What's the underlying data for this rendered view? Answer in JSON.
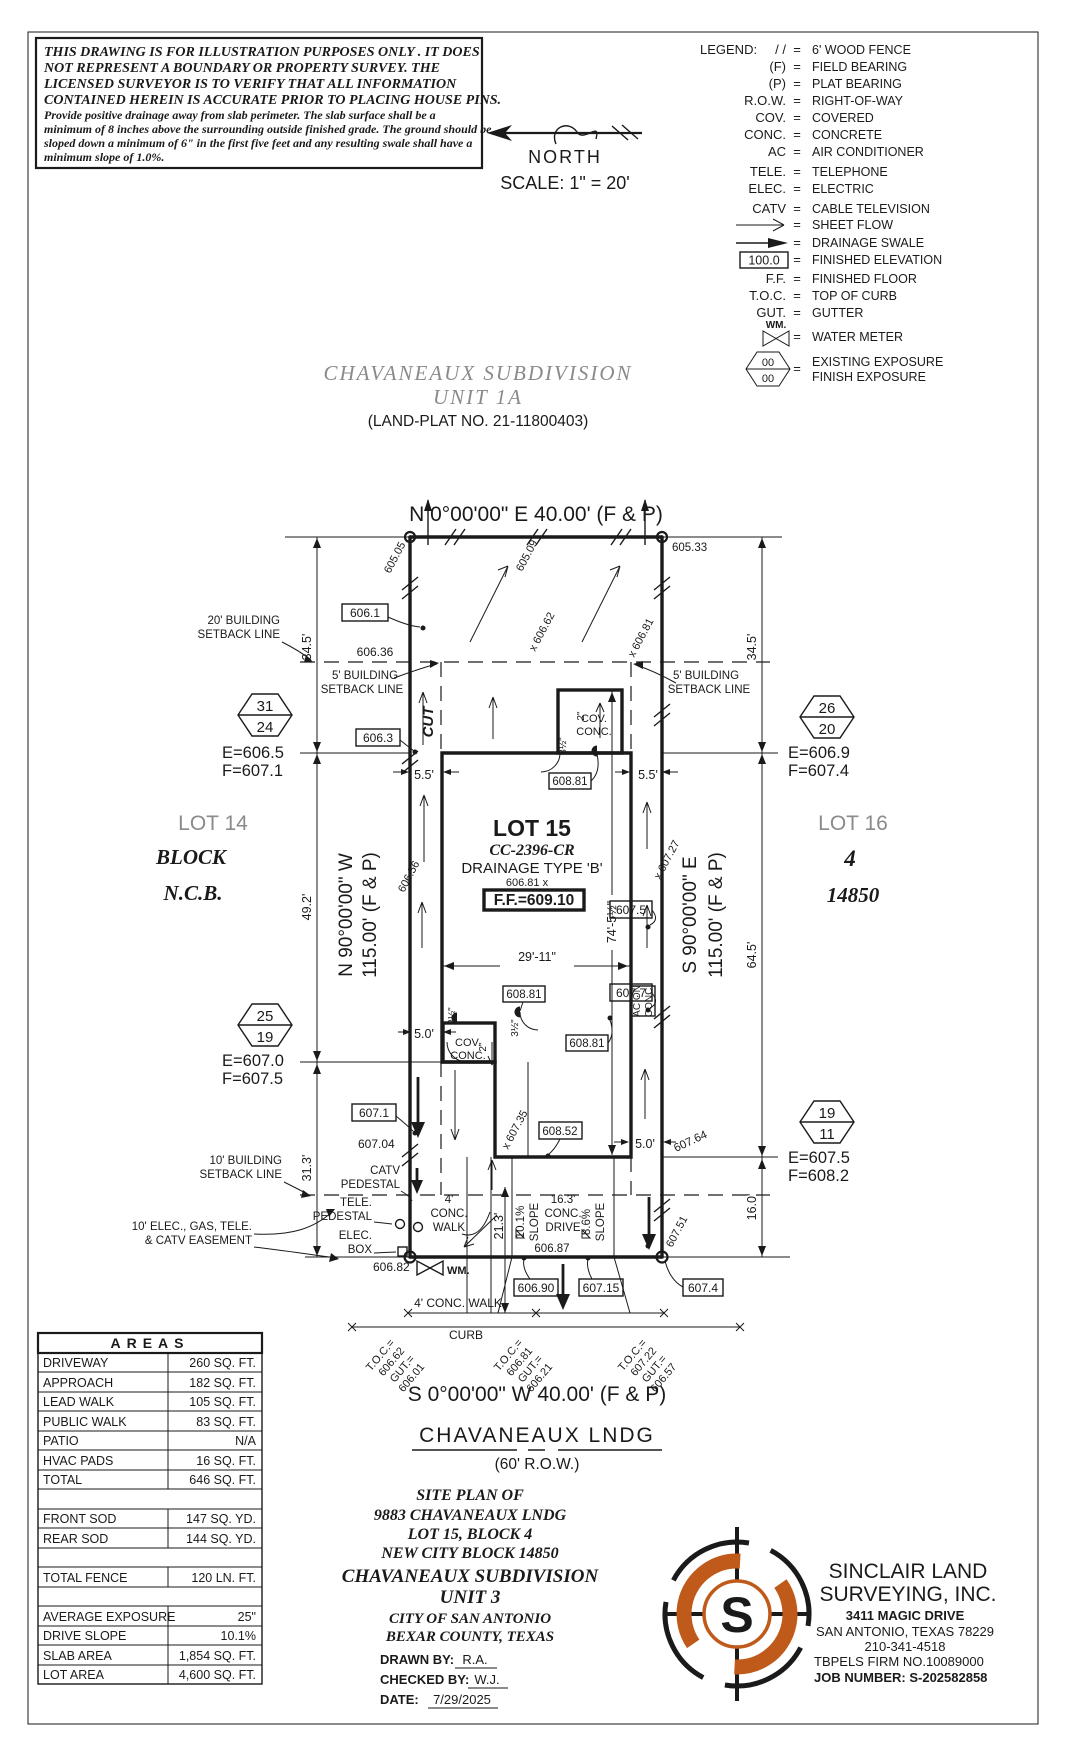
{
  "colors": {
    "ink": "#1a1a1a",
    "gray": "#8a8a8a",
    "orange": "#c05a1a"
  },
  "disclaimer": {
    "b1": "THIS DRAWING IS FOR ILLUSTRATION PURPOSES ONLY . IT DOES",
    "b2": "NOT REPRESENT A BOUNDARY OR PROPERTY SURVEY. THE",
    "b3": "LICENSED SURVEYOR IS TO VERIFY THAT ALL INFORMATION",
    "b4": "CONTAINED HEREIN IS ACCURATE PRIOR TO PLACING HOUSE PINS.",
    "s1": "Provide positive drainage away from slab perimeter. The slab surface shall be a",
    "s2": "minimum of 8 inches above the surrounding outside finished grade. The ground should be",
    "s3": "sloped down a minimum of 6\" in the first five feet and any resulting swale shall have a",
    "s4": "minimum slope of 1.0%."
  },
  "north": {
    "label": "NORTH",
    "scale": "SCALE:  1\" = 20'"
  },
  "legend": {
    "title": "LEGEND:",
    "eq": "=",
    "rows": [
      {
        "sym": "/ /",
        "desc": "6' WOOD FENCE"
      },
      {
        "sym": "(F)",
        "desc": "FIELD BEARING"
      },
      {
        "sym": "(P)",
        "desc": "PLAT BEARING"
      },
      {
        "sym": "R.O.W.",
        "desc": "RIGHT-OF-WAY"
      },
      {
        "sym": "COV.",
        "desc": "COVERED"
      },
      {
        "sym": "CONC.",
        "desc": "CONCRETE"
      },
      {
        "sym": "AC",
        "desc": "AIR CONDITIONER"
      },
      {
        "sym": "TELE.",
        "desc": "TELEPHONE"
      },
      {
        "sym": "ELEC.",
        "desc": "ELECTRIC"
      },
      {
        "sym": "CATV",
        "desc": "CABLE TELEVISION"
      },
      {
        "sym": "",
        "desc": "SHEET FLOW"
      },
      {
        "sym": "",
        "desc": "DRAINAGE SWALE"
      },
      {
        "sym": "100.0",
        "desc": "FINISHED ELEVATION"
      },
      {
        "sym": "F.F.",
        "desc": "FINISHED FLOOR"
      },
      {
        "sym": "T.O.C.",
        "desc": "TOP OF CURB"
      },
      {
        "sym": "GUT.",
        "desc": "GUTTER"
      },
      {
        "sym": "WM.",
        "desc": "WATER METER"
      }
    ],
    "exposure": {
      "top": "00",
      "bottom": "00",
      "desc1": "EXISTING EXPOSURE",
      "desc2": "FINISH EXPOSURE"
    }
  },
  "header": {
    "subdivision": "CHAVANEAUX  SUBDIVISION",
    "unit": "UNIT  1A",
    "plat": "(LAND-PLAT NO. 21-11800403)"
  },
  "bearings": {
    "top": "N  0°00'00\"  E  40.00'  (F & P)",
    "bottom": "S  0°00'00\"  W  40.00'  (F & P)",
    "left1": "N  90°00'00\"  W",
    "left2": "115.00'  (F & P)",
    "right1": "S  90°00'00\"  E",
    "right2": "115.00'  (F & P)"
  },
  "street": {
    "name": "CHAVANEAUX  LNDG",
    "row": "(60'  R.O.W.)"
  },
  "adjacent": {
    "lot14": "LOT 14",
    "block": "BLOCK",
    "ncb": "N.C.B.",
    "lot16": "LOT 16",
    "block_no": "4",
    "ncb_no": "14850"
  },
  "lot": {
    "name": "LOT 15",
    "cc": "CC-2396-CR",
    "drainage": "DRAINAGE TYPE 'B'",
    "spot": "606.81 x",
    "ff": "F.F.=609.10"
  },
  "markers": [
    {
      "top": "31",
      "bottom": "24",
      "e": "E=606.5",
      "f": "F=607.1"
    },
    {
      "top": "25",
      "bottom": "19",
      "e": "E=607.0",
      "f": "F=607.5"
    },
    {
      "top": "26",
      "bottom": "20",
      "e": "E=606.9",
      "f": "F=607.4"
    },
    {
      "top": "19",
      "bottom": "11",
      "e": "E=607.5",
      "f": "F=608.2"
    }
  ],
  "dims": {
    "d345l": "34.5'",
    "d492": "49.2'",
    "d313": "31.3'",
    "d345r": "34.5'",
    "d645": "64.5'",
    "d160": "16.0'",
    "d55l": "5.5'",
    "d55r": "5.5'",
    "d50a": "5.0'",
    "d50b": "5.0'",
    "d2911": "29'-11\"",
    "d745": "74'-5½\"",
    "d213": "21.3'",
    "d2a": "2\"",
    "d2b": "2\"",
    "d35a": "3½\"",
    "d35b": "3½\"",
    "d35c": "3½\""
  },
  "setbacks": {
    "s20a": "20' BUILDING",
    "s20b": "SETBACK LINE",
    "s5la": "5' BUILDING",
    "s5lb": "SETBACK LINE",
    "s5ra": "5' BUILDING",
    "s5rb": "SETBACK LINE",
    "s10a": "10' BUILDING",
    "s10b": "SETBACK LINE",
    "easea": "10' ELEC., GAS, TELE.",
    "easeb": "& CATV EASEMENT"
  },
  "boxes": {
    "b6061": "606.1",
    "b6063": "606.3",
    "b6071": "607.1",
    "b60881a": "608.81",
    "b60881b": "608.81",
    "b60881c": "608.81",
    "b60852": "608.52",
    "b6075": "607.5",
    "b6077": "607.7",
    "b60690": "606.90",
    "b60715": "607.15",
    "b6074": "607.4"
  },
  "spots": {
    "s60505": "605.05",
    "s60509": "605.09",
    "s60533": "605.33",
    "s60636": "606.36",
    "s60662": "x 606.62",
    "s60681": "x 606.81",
    "s60656": "606.56",
    "s60727": "x 607.27",
    "s60704": "607.04",
    "s60735": "x 607.35",
    "s60764": "607.64",
    "s60751": "607.51",
    "s60687": "606.87",
    "s60682": "606.82"
  },
  "toc": [
    {
      "l1": "T.O.C.=",
      "l2": "606.62",
      "l3": "GUT.=",
      "l4": "606.01"
    },
    {
      "l1": "T.O.C.=",
      "l2": "606.81",
      "l3": "GUT.=",
      "l4": "606.21"
    },
    {
      "l1": "T.O.C.=",
      "l2": "607.22",
      "l3": "GUT.=",
      "l4": "606.57"
    }
  ],
  "site": {
    "cut": "CUT",
    "cova": "COV.",
    "covb": "CONC.",
    "cov2a": "COV.",
    "cov2b": "CONC.",
    "ac1": "AC ON",
    "ac2": "CONC.",
    "wm": "WM.",
    "catv1": "CATV",
    "catv2": "PEDESTAL",
    "tele1": "TELE.",
    "tele2": "PEDESTAL",
    "elec1": "ELEC.",
    "elec2": "BOX",
    "walk1": "4'",
    "walk2": "CONC.",
    "walk3": "WALK",
    "slope1a": "10.1%",
    "slope1b": "SLOPE",
    "drive1": "16.3'",
    "drive2": "CONC.",
    "drive3": "DRIVE",
    "slope2a": "8.6%",
    "slope2b": "SLOPE",
    "pubwalk": "4' CONC. WALK",
    "curb": "CURB"
  },
  "table": {
    "title": "AREAS",
    "rows": [
      {
        "label": "DRIVEWAY",
        "value": "260 SQ. FT."
      },
      {
        "label": "APPROACH",
        "value": "182 SQ. FT."
      },
      {
        "label": "LEAD WALK",
        "value": "105 SQ. FT."
      },
      {
        "label": "PUBLIC WALK",
        "value": "83 SQ. FT."
      },
      {
        "label": "PATIO",
        "value": "N/A"
      },
      {
        "label": "HVAC PADS",
        "value": "16 SQ. FT."
      },
      {
        "label": "TOTAL",
        "value": "646 SQ. FT."
      },
      {
        "label": "",
        "value": ""
      },
      {
        "label": "FRONT SOD",
        "value": "147 SQ. YD."
      },
      {
        "label": "REAR SOD",
        "value": "144 SQ. YD."
      },
      {
        "label": "",
        "value": ""
      },
      {
        "label": "TOTAL FENCE",
        "value": "120 LN. FT."
      },
      {
        "label": "",
        "value": ""
      },
      {
        "label": "AVERAGE EXPOSURE",
        "value": "25\""
      },
      {
        "label": "DRIVE SLOPE",
        "value": "10.1%"
      },
      {
        "label": "SLAB AREA",
        "value": "1,854 SQ. FT."
      },
      {
        "label": "LOT AREA",
        "value": "4,600 SQ. FT."
      }
    ]
  },
  "titleblock": {
    "l1": "SITE PLAN OF",
    "l2": "9883 CHAVANEAUX LNDG",
    "l3": "LOT 15, BLOCK 4",
    "l4": "NEW CITY BLOCK 14850",
    "l5": "CHAVANEAUX SUBDIVISION",
    "l6": "UNIT 3",
    "l7": "CITY OF SAN ANTONIO",
    "l8": "BEXAR COUNTY, TEXAS",
    "drawn_label": "DRAWN BY:",
    "drawn": "R.A.",
    "checked_label": "CHECKED BY:",
    "checked": "W.J.",
    "date_label": "DATE:",
    "date": "7/29/2025"
  },
  "firm": {
    "logo_s": "S",
    "name1": "SINCLAIR LAND",
    "name2": "SURVEYING, INC.",
    "addr1": "3411 MAGIC DRIVE",
    "addr2": "SAN ANTONIO, TEXAS 78229",
    "phone": "210-341-4518",
    "tbpels": "TBPELS FIRM NO.10089000",
    "job": "JOB NUMBER: S-202582858"
  }
}
